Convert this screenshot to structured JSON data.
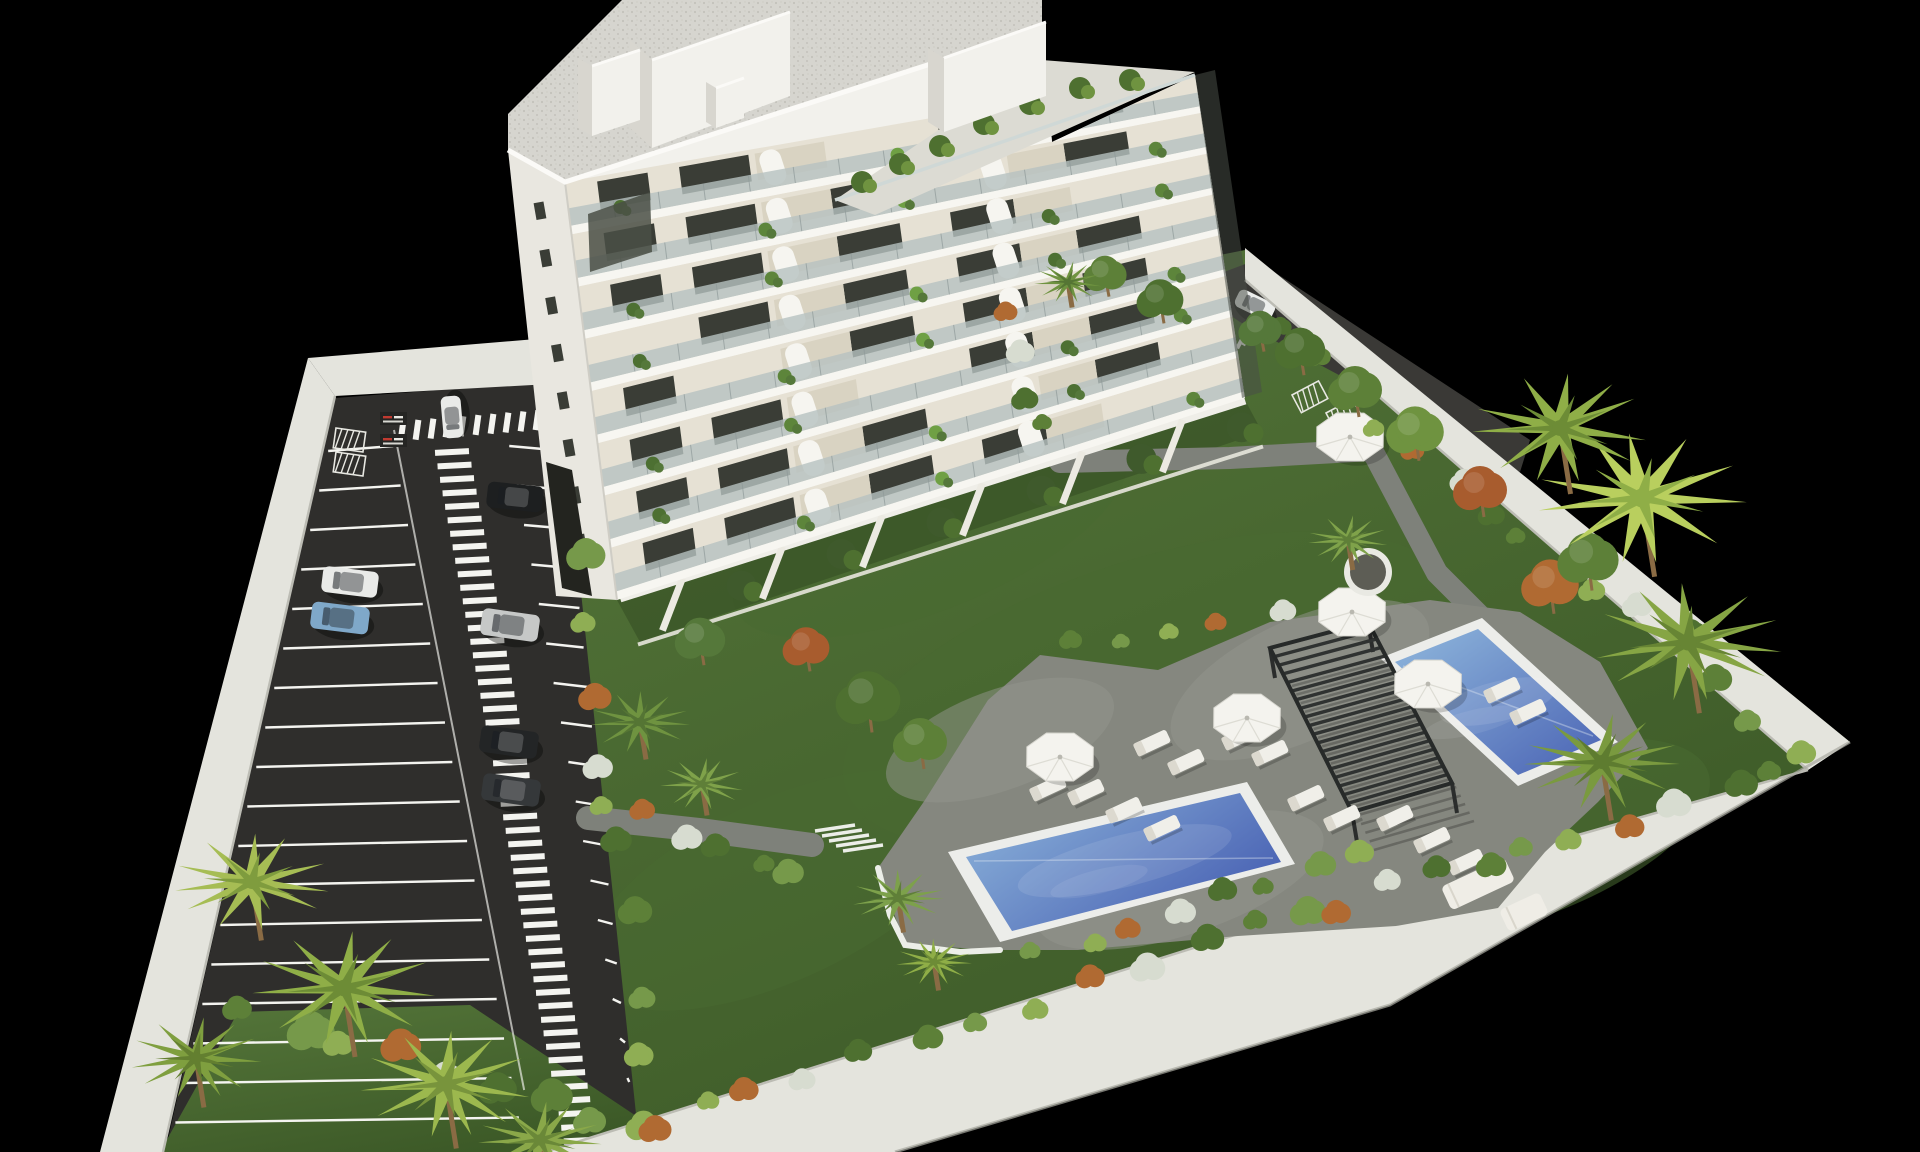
{
  "meta": {
    "title": "Aerial 3D architectural rendering: white apartment tower with balcony gardens, walled parking lot with cars and striped pedestrian walkway, landscaped garden with two blue swimming pools, slatted pergola, parasols, sun loungers and palm trees, on a black background",
    "aria_label": "3D rendered aerial view of a residential development"
  },
  "canvas": {
    "width": 1920,
    "height": 1152,
    "background": "#000000"
  },
  "palette": {
    "lawn_light": "#55763a",
    "lawn_dark": "#3c5927",
    "lawn_mid": "#486931",
    "asphalt": "#2f2e2c",
    "asphalt_light": "#3a3936",
    "deck": "#85877f",
    "deck_light": "#94968d",
    "path": "#7e817a",
    "wall_top": "#e4e4dd",
    "wall_shade": "#bcbcb4",
    "white": "#f2f1ec",
    "white_shade": "#d8d6cf",
    "coping": "#ecedea",
    "pool_deep": "#4a63b4",
    "pool_light": "#8fb7dc",
    "glass": "#b7c2c1",
    "mullion": "#8f9a99",
    "interior_wall": "#e6e1d4",
    "balcony_floor": "#d9d3c2",
    "window": "#3a3d36",
    "roof_gravel": "#d6d5cf",
    "roof_dot": "#c3c2bb",
    "pergola": "#2f3231",
    "trunk": "#8a6b44",
    "stripe": "#f4f4f0",
    "sign_red": "#c03a30"
  },
  "walls": {
    "left": [
      [
        308,
        358
      ],
      [
        335,
        396
      ],
      [
        163,
        1152
      ],
      [
        100,
        1152
      ]
    ],
    "top": [
      [
        308,
        358
      ],
      [
        548,
        338
      ],
      [
        550,
        384
      ],
      [
        335,
        396
      ]
    ],
    "right": [
      [
        1245,
        248
      ],
      [
        1850,
        742
      ],
      [
        1808,
        770
      ],
      [
        1245,
        280
      ]
    ],
    "bottom": [
      [
        545,
        1152
      ],
      [
        1330,
        905
      ],
      [
        1808,
        770
      ],
      [
        1850,
        742
      ],
      [
        1390,
        1005
      ],
      [
        895,
        1152
      ]
    ]
  },
  "ground": {
    "garden": [
      [
        551,
        388
      ],
      [
        1245,
        250
      ],
      [
        1850,
        742
      ],
      [
        1390,
        1005
      ],
      [
        895,
        1152
      ],
      [
        545,
        1152
      ],
      [
        575,
        535
      ]
    ],
    "parking": [
      [
        335,
        398
      ],
      [
        545,
        382
      ],
      [
        575,
        535
      ],
      [
        640,
        1152
      ],
      [
        165,
        1152
      ]
    ],
    "front_lawn": [
      [
        160,
        1152
      ],
      [
        238,
        1012
      ],
      [
        470,
        1005
      ],
      [
        690,
        1152
      ]
    ],
    "shadow_quad": [
      [
        617,
        600
      ],
      [
        1245,
        400
      ],
      [
        1262,
        432
      ],
      [
        640,
        642
      ]
    ],
    "lawn_patches": [
      [
        1150,
        690,
        320,
        130,
        -18
      ],
      [
        780,
        890,
        210,
        90,
        -25
      ],
      [
        1520,
        840,
        200,
        80,
        -20
      ],
      [
        930,
        530,
        210,
        80,
        -22
      ],
      [
        1380,
        700,
        180,
        70,
        -20
      ]
    ]
  },
  "deck": {
    "outline": [
      [
        905,
        945
      ],
      [
        878,
        868
      ],
      [
        925,
        800
      ],
      [
        988,
        700
      ],
      [
        1040,
        655
      ],
      [
        1158,
        670
      ],
      [
        1270,
        622
      ],
      [
        1430,
        600
      ],
      [
        1520,
        612
      ],
      [
        1600,
        662
      ],
      [
        1648,
        748
      ],
      [
        1598,
        802
      ],
      [
        1545,
        852
      ],
      [
        1498,
        908
      ],
      [
        1396,
        926
      ],
      [
        1238,
        936
      ],
      [
        1078,
        950
      ],
      [
        1000,
        950
      ]
    ],
    "curb": [
      [
        878,
        868
      ],
      [
        890,
        915
      ],
      [
        905,
        945
      ],
      [
        960,
        952
      ],
      [
        1000,
        950
      ]
    ],
    "mottles": [
      [
        1000,
        740,
        120,
        50,
        -20
      ],
      [
        1300,
        680,
        140,
        60,
        -25
      ],
      [
        1180,
        880,
        150,
        55,
        -18
      ]
    ]
  },
  "paths": {
    "right_path": [
      [
        1060,
        462
      ],
      [
        1230,
        458
      ],
      [
        1372,
        450
      ],
      [
        1437,
        573
      ],
      [
        1482,
        618
      ]
    ],
    "left_path": [
      [
        588,
        818
      ],
      [
        700,
        830
      ],
      [
        812,
        845
      ]
    ],
    "width_right": 22,
    "width_left": 24
  },
  "stairs": {
    "x": 815,
    "y": 831,
    "steps": 5,
    "len": 40,
    "dx": 7,
    "dy": 5
  },
  "pools": {
    "main": {
      "coping": [
        [
          948,
          852
        ],
        [
          1247,
          782
        ],
        [
          1295,
          864
        ],
        [
          1000,
          942
        ]
      ],
      "water": [
        [
          966,
          857
        ],
        [
          1240,
          793
        ],
        [
          1281,
          862
        ],
        [
          1012,
          931
        ]
      ]
    },
    "secondary": {
      "coping": [
        [
          1380,
          658
        ],
        [
          1482,
          618
        ],
        [
          1618,
          742
        ],
        [
          1518,
          786
        ]
      ],
      "water": [
        [
          1395,
          662
        ],
        [
          1478,
          629
        ],
        [
          1601,
          740
        ],
        [
          1518,
          775
        ]
      ]
    }
  },
  "pergola": {
    "corners": [
      [
        1270,
        648
      ],
      [
        1368,
        622
      ],
      [
        1452,
        783
      ],
      [
        1352,
        812
      ]
    ],
    "slats": 20,
    "shadow_offset": [
      22,
      38
    ]
  },
  "furniture": {
    "parasols": [
      [
        1060,
        757
      ],
      [
        1247,
        718
      ],
      [
        1352,
        612
      ],
      [
        1428,
        684
      ],
      [
        1350,
        437
      ]
    ],
    "parasol_r": 36,
    "loungers": [
      [
        1086,
        792
      ],
      [
        1124,
        810
      ],
      [
        1162,
        828
      ],
      [
        1152,
        743
      ],
      [
        1186,
        762
      ],
      [
        1240,
        737
      ],
      [
        1270,
        753
      ],
      [
        1306,
        798
      ],
      [
        1342,
        818
      ],
      [
        1395,
        818
      ],
      [
        1432,
        840
      ],
      [
        1466,
        862
      ],
      [
        1048,
        788
      ],
      [
        1502,
        690
      ],
      [
        1528,
        712
      ]
    ],
    "lounger_angle": -25,
    "sofas": [
      [
        1478,
        884,
        70,
        26
      ],
      [
        1524,
        912,
        44,
        24
      ]
    ]
  },
  "parking": {
    "stall_count": 18,
    "stall_y0": 448,
    "stall_dy": 39.5,
    "left_wall_x": {
      "x0": 335,
      "y0": 396,
      "x1": 163,
      "y1": 1152
    },
    "walkway": {
      "y0": 452,
      "y1": 1148,
      "step": 13.5,
      "x0": 452,
      "drift": 0.187,
      "bar_w": 34,
      "bar_h": 6
    },
    "crosswalk_top": {
      "x0": 402,
      "y0": 431,
      "x1": 552,
      "y1": 419,
      "bars": 11
    },
    "cars": [
      {
        "color": "#e9eae8",
        "cx": 452,
        "cy": 417,
        "angle": -95,
        "len": 42,
        "wid": 20
      },
      {
        "color": "#1d1f20",
        "cx": 515,
        "cy": 497,
        "angle": 6,
        "len": 56,
        "wid": 26
      },
      {
        "color": "#e9eae8",
        "cx": 350,
        "cy": 582,
        "angle": 7,
        "len": 56,
        "wid": 26
      },
      {
        "color": "#7fa8c9",
        "cx": 340,
        "cy": 618,
        "angle": 7,
        "len": 58,
        "wid": 27
      },
      {
        "color": "#c6c8c7",
        "cx": 510,
        "cy": 625,
        "angle": 8,
        "len": 58,
        "wid": 27
      },
      {
        "color": "#232526",
        "cx": 509,
        "cy": 742,
        "angle": 8,
        "len": 58,
        "wid": 27
      },
      {
        "color": "#35383a",
        "cx": 511,
        "cy": 790,
        "angle": 8,
        "len": 58,
        "wid": 27
      }
    ],
    "signs": [
      [
        380,
        412
      ],
      [
        380,
        434
      ]
    ],
    "bike_racks": [
      [
        336,
        428
      ],
      [
        336,
        452
      ]
    ]
  },
  "drive": {
    "outline": [
      [
        1208,
        278
      ],
      [
        1256,
        260
      ],
      [
        1530,
        440
      ],
      [
        1520,
        472
      ],
      [
        1240,
        322
      ],
      [
        1208,
        300
      ]
    ],
    "car": {
      "color": "#eceeec",
      "cx": 1255,
      "cy": 305,
      "angle": 26,
      "len": 40,
      "wid": 19
    },
    "crosswalk": {
      "cx": 1252,
      "cy": 331,
      "bars": 5
    },
    "bike_racks": [
      [
        1292,
        395
      ],
      [
        1326,
        413
      ]
    ]
  },
  "building": {
    "outline": [
      [
        565,
        182
      ],
      [
        1042,
        28
      ],
      [
        1052,
        142
      ],
      [
        1195,
        75
      ],
      [
        1245,
        398
      ],
      [
        617,
        600
      ]
    ],
    "front": {
      "tl": [
        565,
        182
      ],
      "tr": [
        1195,
        72
      ],
      "bl": [
        617,
        600
      ],
      "br": [
        1245,
        398
      ],
      "floors": 8,
      "windows": [
        [
          0.05,
          0.13
        ],
        [
          0.18,
          0.29
        ],
        [
          0.41,
          0.51
        ],
        [
          0.59,
          0.69
        ],
        [
          0.78,
          0.88
        ]
      ],
      "arches": [
        0.33,
        0.67
      ],
      "plants": [
        0.08,
        0.3,
        0.52,
        0.74,
        0.92
      ]
    },
    "right_recess": [
      [
        1195,
        75
      ],
      [
        1215,
        70
      ],
      [
        1262,
        392
      ],
      [
        1242,
        398
      ]
    ],
    "left_sliver": {
      "quad": [
        [
          508,
          150
        ],
        [
          565,
          182
        ],
        [
          617,
          600
        ],
        [
          556,
          596
        ]
      ],
      "windows": 8
    },
    "garage": [
      [
        546,
        462
      ],
      [
        572,
        470
      ],
      [
        592,
        596
      ],
      [
        562,
        588
      ]
    ],
    "roof": {
      "outline": [
        [
          508,
          150
        ],
        [
          565,
          182
        ],
        [
          1042,
          28
        ],
        [
          1042,
          0
        ],
        [
          622,
          0
        ],
        [
          508,
          114
        ]
      ],
      "terrace": [
        [
          835,
          200
        ],
        [
          1042,
          60
        ],
        [
          1195,
          72
        ],
        [
          875,
          215
        ]
      ],
      "terrace_rail": [
        [
          835,
          200
        ],
        [
          1195,
          75
        ]
      ],
      "terrace_plants": [
        [
          862,
          182
        ],
        [
          900,
          164
        ],
        [
          940,
          146
        ],
        [
          984,
          124
        ],
        [
          1030,
          104
        ],
        [
          1080,
          88
        ],
        [
          1130,
          80
        ]
      ],
      "glass": [
        [
          588,
          214
        ],
        [
          650,
          192
        ],
        [
          652,
          252
        ],
        [
          590,
          272
        ]
      ]
    },
    "penthouses": [
      {
        "front": [
          [
            652,
            60
          ],
          [
            790,
            12
          ],
          [
            790,
            96
          ],
          [
            652,
            148
          ]
        ],
        "side": [
          [
            630,
            40
          ],
          [
            652,
            60
          ],
          [
            652,
            148
          ],
          [
            630,
            128
          ]
        ]
      },
      {
        "front": [
          [
            944,
            58
          ],
          [
            1046,
            22
          ],
          [
            1046,
            96
          ],
          [
            944,
            132
          ]
        ],
        "side": [
          [
            928,
            48
          ],
          [
            944,
            58
          ],
          [
            944,
            132
          ],
          [
            928,
            122
          ]
        ]
      },
      {
        "front": [
          [
            592,
            66
          ],
          [
            640,
            50
          ],
          [
            640,
            120
          ],
          [
            592,
            136
          ]
        ],
        "side": [
          [
            578,
            58
          ],
          [
            592,
            66
          ],
          [
            592,
            136
          ],
          [
            578,
            128
          ]
        ]
      },
      {
        "front": [
          [
            716,
            88
          ],
          [
            744,
            78
          ],
          [
            744,
            118
          ],
          [
            716,
            128
          ]
        ],
        "side": [
          [
            706,
            82
          ],
          [
            716,
            88
          ],
          [
            716,
            128
          ],
          [
            706,
            122
          ]
        ]
      }
    ],
    "terraces": {
      "base0": [
        620,
        598
      ],
      "base1": [
        1245,
        400
      ],
      "dividers": [
        0.1,
        0.26,
        0.42,
        0.58,
        0.74,
        0.9
      ],
      "perp": [
        0.36,
        0.93
      ],
      "wall_len": 50
    }
  },
  "vegetation": {
    "palms": [
      [
        252,
        882,
        78,
        "#a6bd54",
        "#7f9c3e"
      ],
      [
        344,
        988,
        92,
        "#8fae47",
        "#6d8c36"
      ],
      [
        446,
        1084,
        86,
        "#9cb84e",
        "#78943c"
      ],
      [
        196,
        1058,
        66,
        "#7f9f3f",
        "#637f30"
      ],
      [
        540,
        1140,
        62,
        "#8aa849",
        "#6a8838"
      ],
      [
        640,
        722,
        50,
        "#6f9340",
        "#557534"
      ],
      [
        702,
        784,
        42,
        "#7fa24a",
        "#5f7f38"
      ],
      [
        898,
        898,
        46,
        "#7da14b",
        "#5f7f38"
      ],
      [
        934,
        962,
        38,
        "#8fae47",
        "#6d8c36"
      ],
      [
        1642,
        498,
        105,
        "#b9cf5e",
        "#8fae47"
      ],
      [
        1560,
        428,
        88,
        "#8fae47",
        "#6d8c36"
      ],
      [
        1688,
        642,
        95,
        "#86a544",
        "#678534"
      ],
      [
        1602,
        762,
        78,
        "#7a9a3f",
        "#5e7c30"
      ],
      [
        1348,
        540,
        40,
        "#7fa24a",
        "#5f7f38"
      ],
      [
        1068,
        282,
        34,
        "#6f9340",
        "#557534"
      ]
    ],
    "trees": [
      [
        1300,
        350,
        28,
        "#4e7030"
      ],
      [
        1355,
        390,
        30,
        "#5d8038"
      ],
      [
        1415,
        432,
        32,
        "#6f9340"
      ],
      [
        1480,
        490,
        30,
        "#a85c2e"
      ],
      [
        1550,
        585,
        32,
        "#b06a32"
      ],
      [
        1588,
        560,
        34,
        "#5d8038"
      ],
      [
        1260,
        330,
        24,
        "#55783a"
      ],
      [
        1160,
        300,
        26,
        "#4e7030"
      ],
      [
        1105,
        275,
        24,
        "#5d8038"
      ],
      [
        868,
        700,
        36,
        "#4e7030"
      ],
      [
        920,
        742,
        30,
        "#5d8038"
      ],
      [
        806,
        648,
        26,
        "#a85c2e"
      ],
      [
        700,
        640,
        28,
        "#55783a"
      ]
    ],
    "bush_lines": [
      {
        "from": [
          250,
          1008
        ],
        "to": [
          648,
          1128
        ],
        "n": 9,
        "r": 22
      },
      {
        "from": [
          580,
          556
        ],
        "to": [
          648,
          1138
        ],
        "n": 9,
        "r": 18
      },
      {
        "from": [
          700,
          1108
        ],
        "to": [
          1320,
          912
        ],
        "n": 12,
        "r": 16
      },
      {
        "from": [
          1330,
          905
        ],
        "to": [
          1780,
          775
        ],
        "n": 10,
        "r": 16
      },
      {
        "from": [
          1650,
          600
        ],
        "to": [
          1790,
          760
        ],
        "n": 5,
        "r": 18
      },
      {
        "from": [
          1270,
          330
        ],
        "to": [
          1600,
          600
        ],
        "n": 10,
        "r": 13
      },
      {
        "from": [
          1060,
          640
        ],
        "to": [
          1280,
          615
        ],
        "n": 5,
        "r": 12
      },
      {
        "from": [
          1040,
          950
        ],
        "to": [
          1360,
          852
        ],
        "n": 8,
        "r": 14
      },
      {
        "from": [
          600,
          800
        ],
        "to": [
          800,
          872
        ],
        "n": 6,
        "r": 14
      },
      {
        "from": [
          1012,
          320
        ],
        "to": [
          1046,
          432
        ],
        "n": 4,
        "r": 13
      }
    ],
    "bush_colors": [
      "#5d8038",
      "#76994a",
      "#8fae54",
      "#b06a32",
      "#d7dcd0",
      "#4e7030"
    ],
    "planter": {
      "cx": 1368,
      "cy": 572,
      "r": 24
    }
  }
}
